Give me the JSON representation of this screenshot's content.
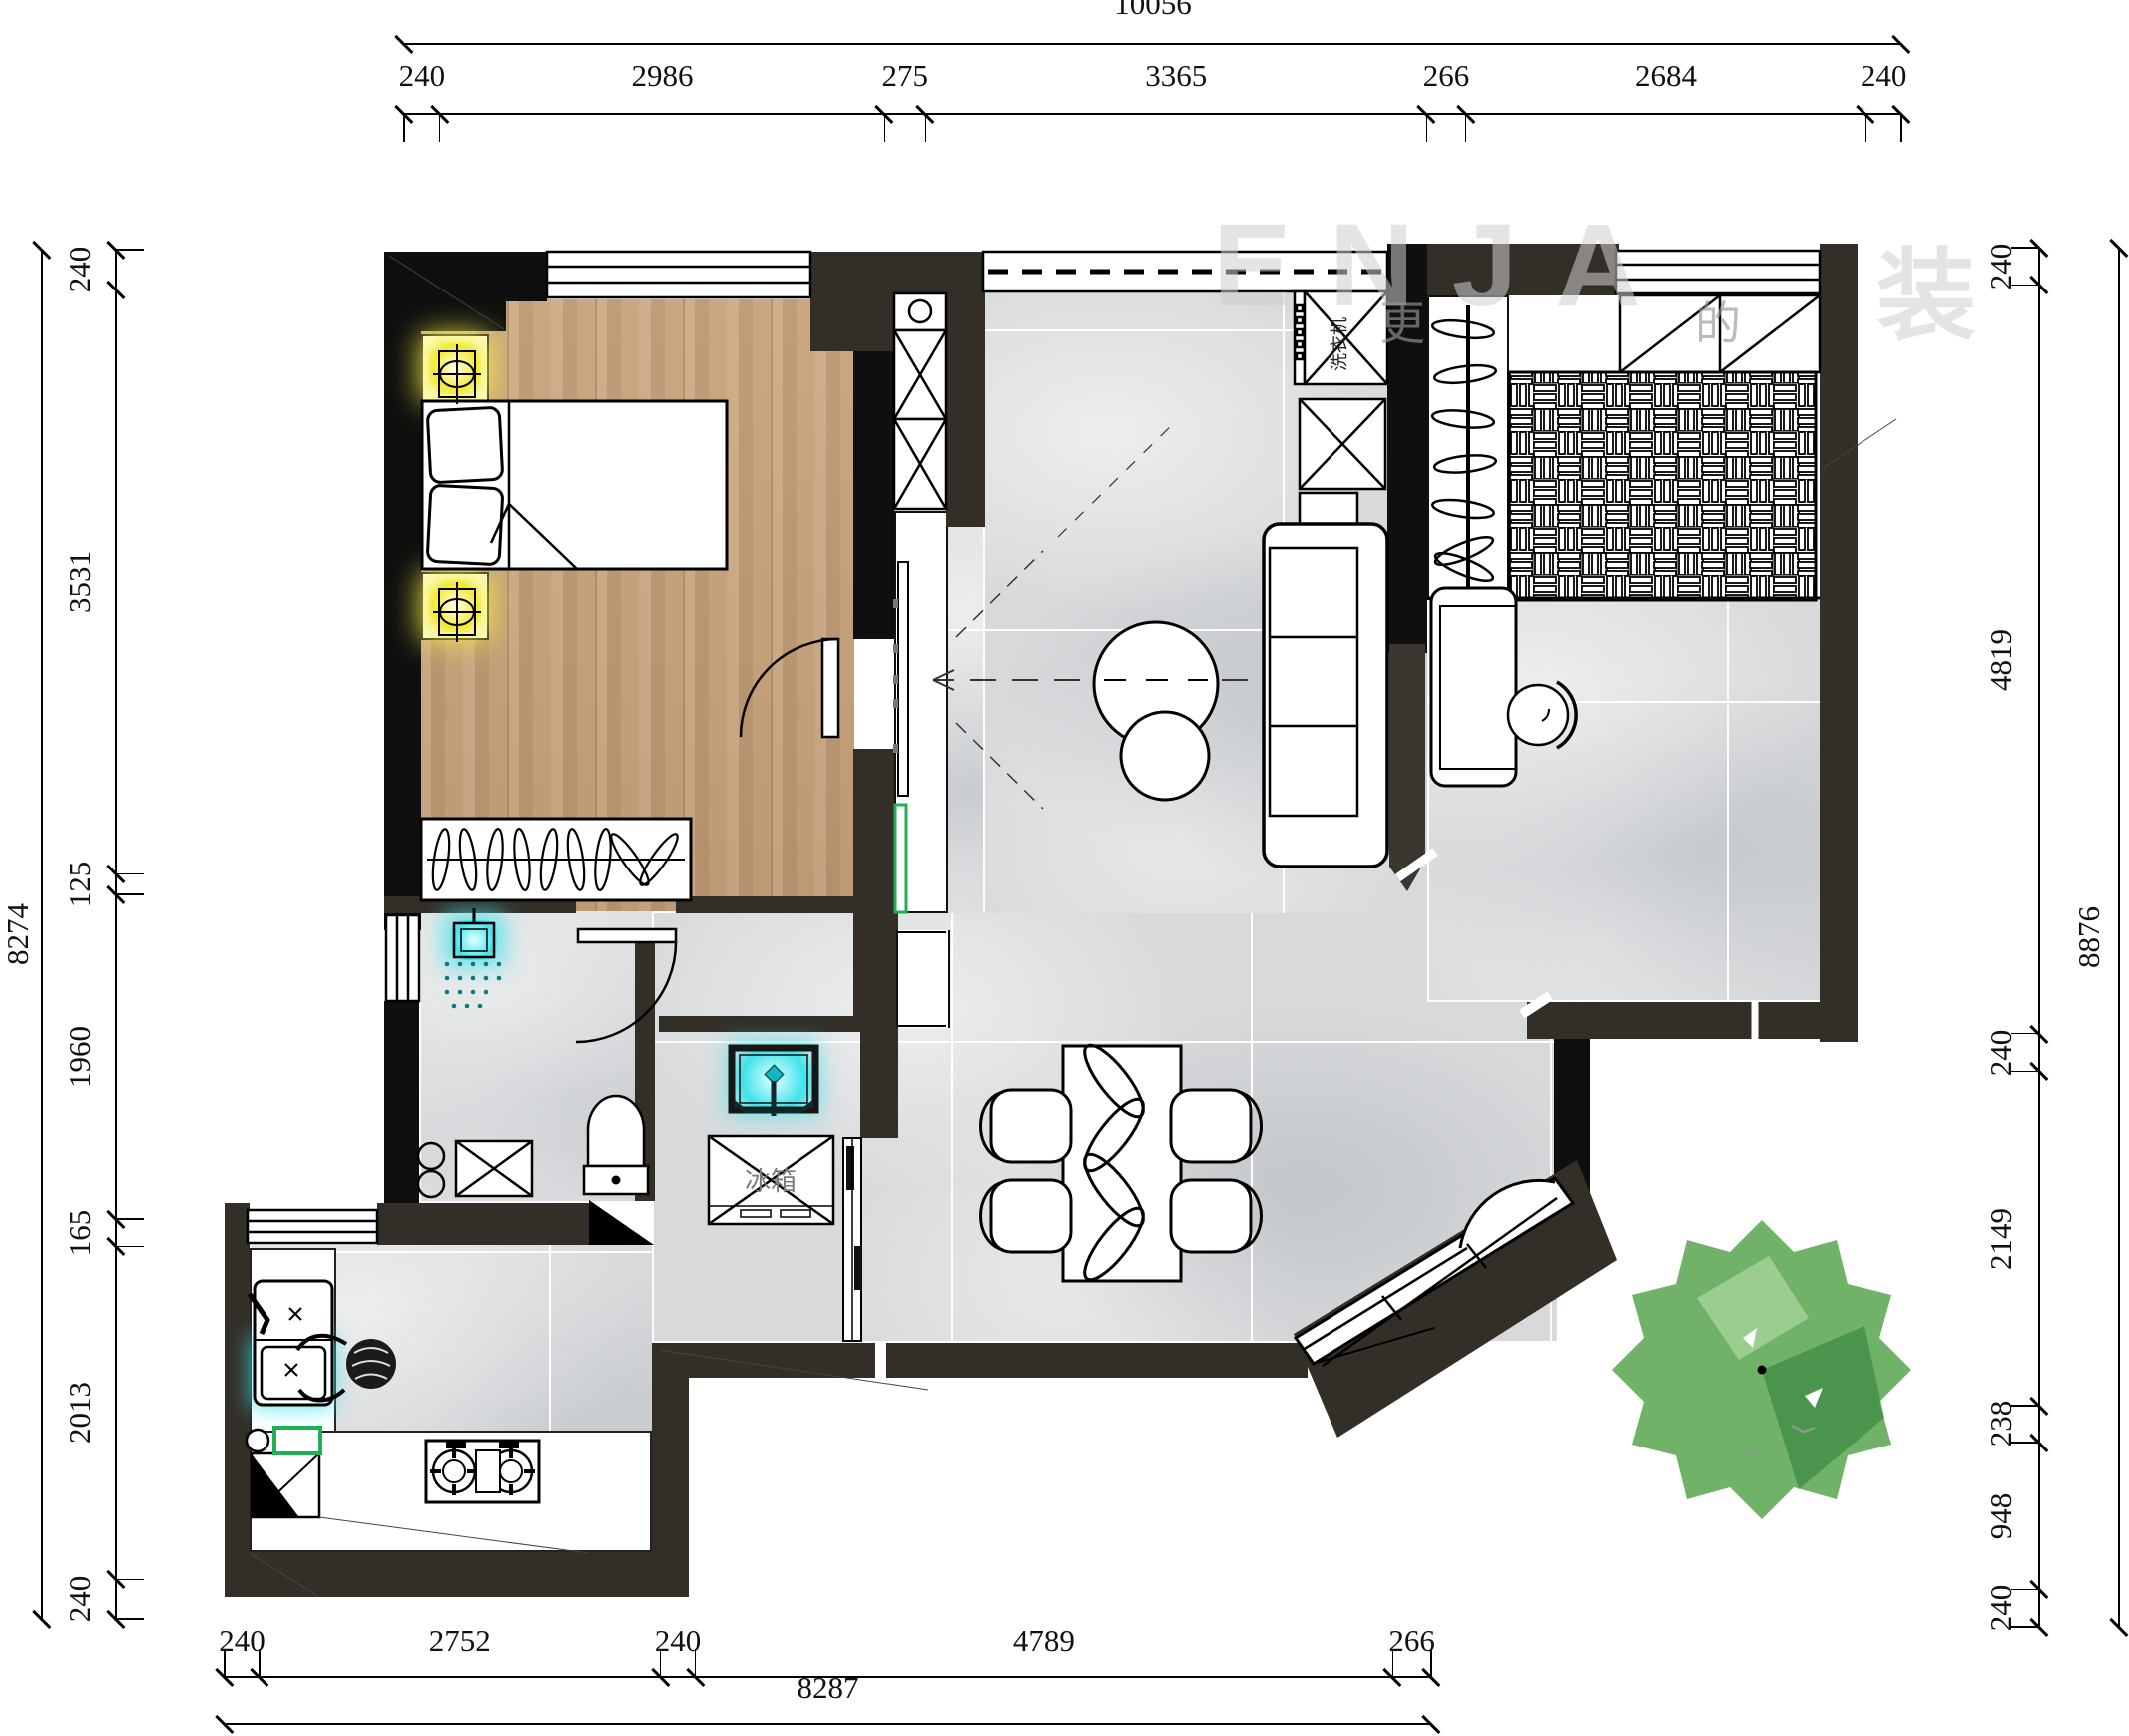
{
  "drawing": {
    "type": "apartment floor plan, top view"
  },
  "labels": {
    "fridge": "冰箱",
    "washer": "洗衣机"
  },
  "watermark": {
    "brand": "ENJA",
    "glyph": "装",
    "tagline_left": "更",
    "tagline_right": "的"
  },
  "dimensions": {
    "top": {
      "total": "10056",
      "segments": [
        "240",
        "2986",
        "275",
        "3365",
        "266",
        "2684",
        "240"
      ]
    },
    "left": {
      "total": "8274",
      "segments": [
        "240",
        "3531",
        "125",
        "1960",
        "165",
        "2013",
        "240"
      ]
    },
    "right": {
      "total": "8876",
      "segments": [
        "240",
        "4819",
        "240",
        "2149",
        "238",
        "948",
        "240"
      ]
    },
    "bottom": {
      "total": "8287",
      "segments": [
        "240",
        "2752",
        "240",
        "4789",
        "266"
      ]
    }
  },
  "colors": {
    "wall": "#332e28",
    "wood": "#c7a077",
    "tile": "#d7d9db",
    "lamp": "#f2ea32",
    "aqua": "#3fe3ea",
    "green": "#1faf54",
    "tree1": "#6fb268",
    "tree2": "#3f8a45",
    "tree3": "#a7d39a"
  }
}
